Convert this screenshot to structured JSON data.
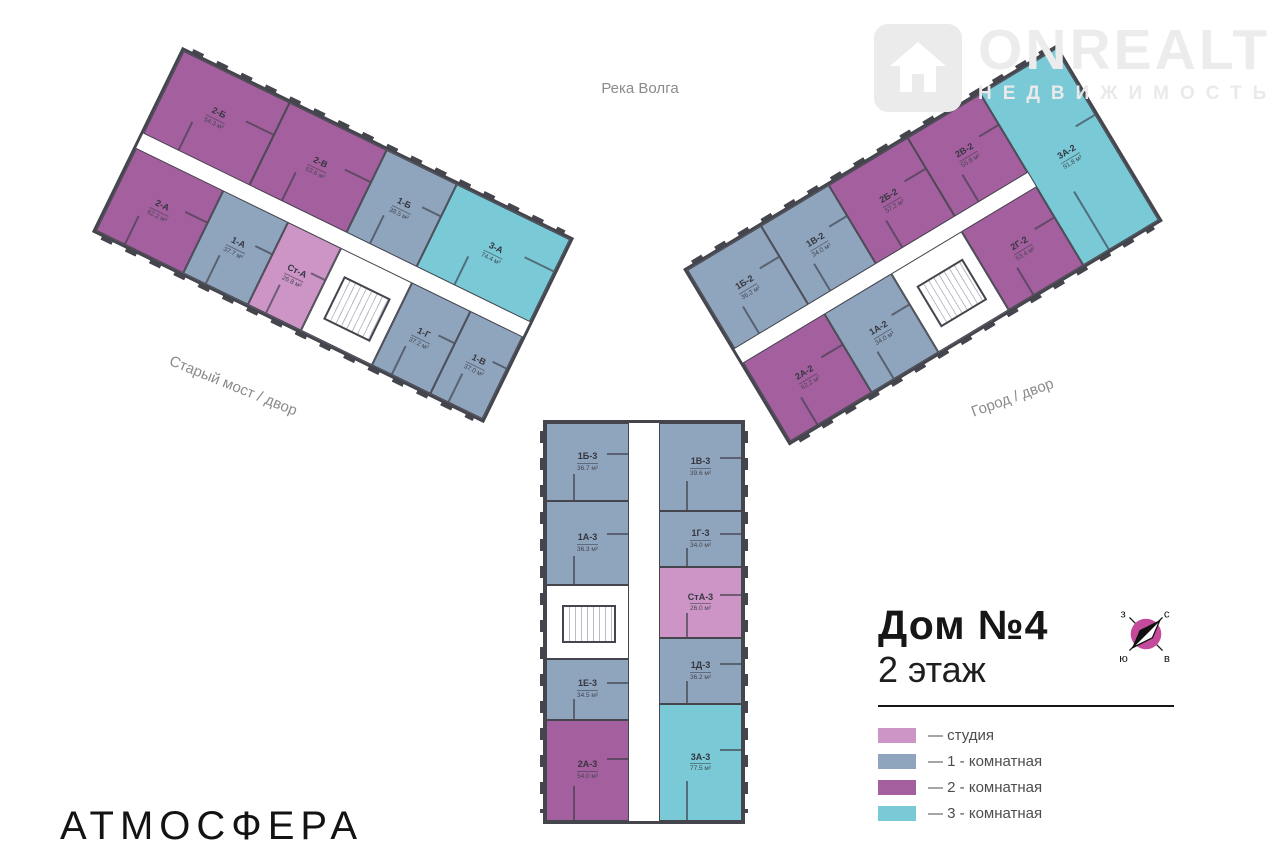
{
  "watermark": {
    "brand": "ONREALT",
    "subtitle": "НЕДВИЖИМОСТЬ"
  },
  "labels": {
    "river": "Река Волга",
    "left_street": "Старый мост / двор",
    "right_street": "Город / двор"
  },
  "title": {
    "house": "Дом №4",
    "floor": "2 этаж"
  },
  "developer": "АТМОСФЕРА",
  "compass": {
    "nw": "з",
    "ne": "с",
    "sw": "ю",
    "se": "в"
  },
  "colors": {
    "studio": "#cc95c6",
    "k1": "#8fa5bd",
    "k2": "#a45f9f",
    "k3": "#79c9d7",
    "core": "#ffffff",
    "wall": "#45454e",
    "compass_disc": "#c44b9c"
  },
  "legend": [
    {
      "label": "— студия",
      "type": "studio"
    },
    {
      "label": "— 1 - комнатная",
      "type": "k1"
    },
    {
      "label": "— 2 - комнатная",
      "type": "k2"
    },
    {
      "label": "— 3 - комнатная",
      "type": "k3"
    }
  ],
  "buildings": [
    {
      "key": "left",
      "corridor": 16,
      "vertical": false,
      "rows": [
        [
          {
            "id": "2-Б",
            "area": "54.3 м²",
            "type": "k2",
            "size": 118
          },
          {
            "id": "2-В",
            "area": "53.6 м²",
            "type": "k2",
            "size": 108
          },
          {
            "id": "1-Б",
            "area": "38.5 м²",
            "type": "k1",
            "size": 78
          },
          {
            "id": "3-А",
            "area": "74.4 м²",
            "type": "k3",
            "size": 126
          }
        ],
        [
          {
            "id": "2-А",
            "area": "62.2 м²",
            "type": "k2",
            "size": 98
          },
          {
            "id": "1-А",
            "area": "37.7 м²",
            "type": "k1",
            "size": 72
          },
          {
            "id": "Ст-А",
            "area": "26.8 м²",
            "type": "studio",
            "size": 58
          },
          {
            "type": "core",
            "size": 80
          },
          {
            "id": "1-Г",
            "area": "37.2 м²",
            "type": "k1",
            "size": 64
          },
          {
            "id": "1-В",
            "area": "37.0 м²",
            "type": "k1",
            "size": 58
          }
        ]
      ]
    },
    {
      "key": "right",
      "corridor": 16,
      "vertical": false,
      "endcap": {
        "id": "3А-2",
        "area": "91.8 м²",
        "type": "k3",
        "size": 86
      },
      "rows": [
        [
          {
            "id": "1Б-2",
            "area": "36.2 м²",
            "type": "k1",
            "size": 86
          },
          {
            "id": "1В-2",
            "area": "34.0 м²",
            "type": "k1",
            "size": 80
          },
          {
            "id": "2Б-2",
            "area": "57.2 м²",
            "type": "k2",
            "size": 92
          },
          {
            "id": "2В-2",
            "area": "55.8 м²",
            "type": "k2",
            "size": 86
          }
        ],
        [
          {
            "id": "2А-2",
            "area": "62.2 м²",
            "type": "k2",
            "size": 96
          },
          {
            "id": "1А-2",
            "area": "34.0 м²",
            "type": "k1",
            "size": 78
          },
          {
            "type": "core",
            "size": 82
          },
          {
            "id": "2Г-2",
            "area": "53.4 м²",
            "type": "k2",
            "size": 88
          }
        ]
      ]
    },
    {
      "key": "bottom",
      "corridor": 30,
      "vertical": true,
      "rows": [
        [
          {
            "id": "1Б-3",
            "area": "36.7 м²",
            "type": "k1",
            "size": 78
          },
          {
            "id": "1А-3",
            "area": "36.3 м²",
            "type": "k1",
            "size": 84
          },
          {
            "type": "core",
            "size": 74
          },
          {
            "id": "1Е-3",
            "area": "34.5 м²",
            "type": "k1",
            "size": 60
          },
          {
            "id": "2А-3",
            "area": "54.0 м²",
            "type": "k2",
            "size": 102
          }
        ],
        [
          {
            "id": "1В-3",
            "area": "39.6 м²",
            "type": "k1",
            "size": 88
          },
          {
            "id": "1Г-3",
            "area": "34.0 м²",
            "type": "k1",
            "size": 56
          },
          {
            "id": "СтА-3",
            "area": "26.0 м²",
            "type": "studio",
            "size": 70
          },
          {
            "id": "1Д-3",
            "area": "36.2 м²",
            "type": "k1",
            "size": 66
          },
          {
            "id": "3А-3",
            "area": "77.5 м²",
            "type": "k3",
            "size": 118
          }
        ]
      ]
    }
  ]
}
